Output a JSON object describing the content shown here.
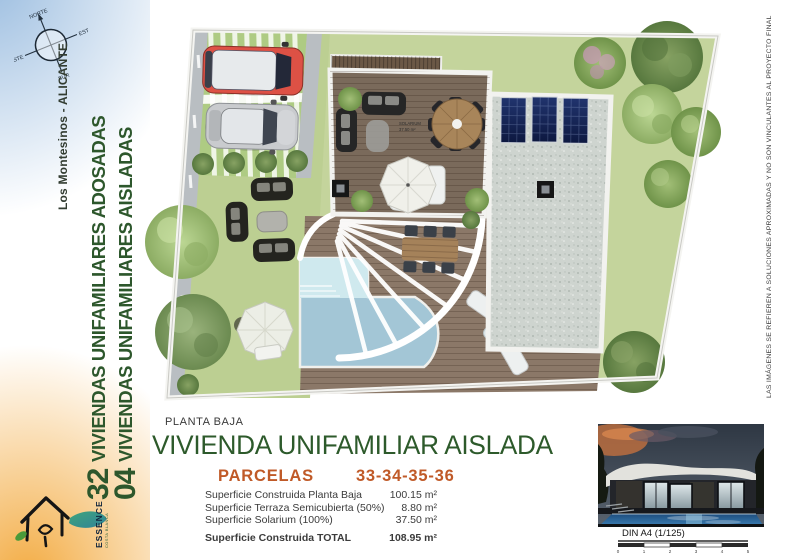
{
  "compass": {
    "north": "NORTE",
    "east": "ESTE",
    "south": "SUR",
    "west": "OESTE"
  },
  "sidebar": {
    "location": "Los Montesinos - ALICANTE",
    "project_lines": [
      {
        "number": "32",
        "label": "VIVIENDAS UNIFAMILIARES ADOSADAS"
      },
      {
        "number": "04",
        "label": "VIVIENDAS UNIFAMILIARES AISLADAS"
      }
    ],
    "logo": {
      "brand": "ESSENCE",
      "tagline": "COSTA BLANCA"
    }
  },
  "plan": {
    "solarium_note_line1": "SOLARIUM",
    "solarium_note_line2": "37.50 m²"
  },
  "details": {
    "floor_label": "PLANTA BAJA",
    "title": "VIVIENDA UNIFAMILIAR AISLADA",
    "parcels_label": "PARCELAS",
    "parcels_numbers": "33-34-35-36",
    "surfaces": [
      {
        "label": "Superficie Construida Planta Baja",
        "value": "100.15 m²"
      },
      {
        "label": "Superficie Terraza Semicubierta (50%)",
        "value": "8.80 m²"
      },
      {
        "label": "Superficie Solarium (100%)",
        "value": "37.50 m²"
      }
    ],
    "total": {
      "label": "Superficie Construida TOTAL",
      "value": "108.95 m²"
    }
  },
  "render": {
    "scale_label": "DIN A4 (1/125)",
    "ticks": [
      "0",
      "1",
      "2",
      "3",
      "4",
      "5"
    ]
  },
  "disclaimer": "LAS IMÁGENES SE REFIEREN A SOLUCIONES APROXIMADAS Y NO SON VINCULANTES AL PROYECTO FINAL",
  "colors": {
    "accent_green": "#2d5a2b",
    "accent_orange": "#c05a28",
    "sidebar_blue": "#92b7dd",
    "sidebar_orange": "#f2a636",
    "lawn": "#c4d49c",
    "pool": "#a3c6d6",
    "deck": "#7e6d5e",
    "gravel": "#ced4cf",
    "solar_panel": "#16255e"
  }
}
